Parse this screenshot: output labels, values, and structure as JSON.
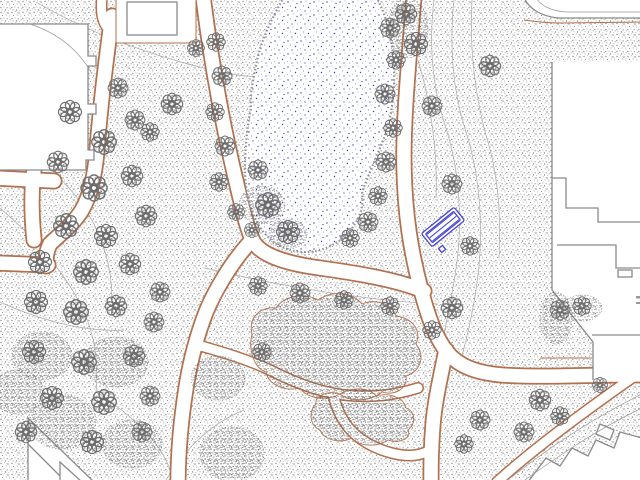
{
  "app": {
    "type": "cad-site-plan",
    "description": "Plan view of a park: pond, lawns with trees and shrubs, footpaths, surrounding buildings, contour lines, one highlighted bench"
  },
  "colors": {
    "background": "#ffffff",
    "grass_dot": "#909090",
    "shrub_dot": "#575757",
    "path_edge": "#b2714f",
    "path_core": "#ffffff",
    "building_outline": "#8a8a8a",
    "contour": "#a8a8a8",
    "pond_dot": "#3d3dcc",
    "pond_dot_light": "#8f8fdf",
    "pond_fringe": "#8f8f8f",
    "bench": "#4747d1",
    "tree_outline": "#6e6e6e"
  },
  "legend_features": [
    {
      "symbol": "pond",
      "desc": "water body, blue stipple on white"
    },
    {
      "symbol": "grass",
      "desc": "gray stipple ground texture"
    },
    {
      "symbol": "tree",
      "desc": "scalloped circular canopy symbol"
    },
    {
      "symbol": "shrub-mass",
      "desc": "dense dark stipple blob with brown edge"
    },
    {
      "symbol": "path",
      "desc": "white corridor with brown edges"
    },
    {
      "symbol": "building",
      "desc": "white footprint with gray outline"
    },
    {
      "symbol": "contour-line",
      "desc": "thin gray curve"
    },
    {
      "symbol": "bench",
      "desc": "blue highlighted street-furniture symbol"
    }
  ],
  "map": {
    "bench": {
      "x": 443,
      "y": 227,
      "rotation": -39,
      "length": 42,
      "width": 17,
      "slats": 3,
      "pad": {
        "dx": -17,
        "dy": 14,
        "size": 5
      }
    },
    "trees": [
      {
        "x": 70,
        "y": 112,
        "s": 1.5
      },
      {
        "x": 104,
        "y": 142,
        "s": 1.6
      },
      {
        "x": 135,
        "y": 120,
        "s": 1.3
      },
      {
        "x": 58,
        "y": 162,
        "s": 1.4
      },
      {
        "x": 94,
        "y": 188,
        "s": 1.7
      },
      {
        "x": 132,
        "y": 176,
        "s": 1.4
      },
      {
        "x": 66,
        "y": 226,
        "s": 1.6
      },
      {
        "x": 106,
        "y": 236,
        "s": 1.5
      },
      {
        "x": 146,
        "y": 216,
        "s": 1.4
      },
      {
        "x": 40,
        "y": 262,
        "s": 1.5
      },
      {
        "x": 86,
        "y": 272,
        "s": 1.6
      },
      {
        "x": 130,
        "y": 264,
        "s": 1.4
      },
      {
        "x": 160,
        "y": 292,
        "s": 1.3
      },
      {
        "x": 36,
        "y": 302,
        "s": 1.5
      },
      {
        "x": 76,
        "y": 312,
        "s": 1.6
      },
      {
        "x": 116,
        "y": 306,
        "s": 1.4
      },
      {
        "x": 154,
        "y": 322,
        "s": 1.3
      },
      {
        "x": 118,
        "y": 88,
        "s": 1.3
      },
      {
        "x": 172,
        "y": 104,
        "s": 1.4
      },
      {
        "x": 150,
        "y": 132,
        "s": 1.2
      },
      {
        "x": 196,
        "y": 48,
        "s": 1.1
      },
      {
        "x": 216,
        "y": 42,
        "s": 1.2
      },
      {
        "x": 222,
        "y": 76,
        "s": 1.3
      },
      {
        "x": 215,
        "y": 112,
        "s": 1.2
      },
      {
        "x": 225,
        "y": 146,
        "s": 1.3
      },
      {
        "x": 219,
        "y": 182,
        "s": 1.2
      },
      {
        "x": 236,
        "y": 212,
        "s": 1.1
      },
      {
        "x": 252,
        "y": 230,
        "s": 1.0
      },
      {
        "x": 268,
        "y": 205,
        "s": 1.6
      },
      {
        "x": 288,
        "y": 232,
        "s": 1.5
      },
      {
        "x": 258,
        "y": 170,
        "s": 1.3
      },
      {
        "x": 390,
        "y": 28,
        "s": 1.3
      },
      {
        "x": 396,
        "y": 60,
        "s": 1.2
      },
      {
        "x": 385,
        "y": 94,
        "s": 1.3
      },
      {
        "x": 393,
        "y": 128,
        "s": 1.2
      },
      {
        "x": 386,
        "y": 162,
        "s": 1.3
      },
      {
        "x": 378,
        "y": 196,
        "s": 1.2
      },
      {
        "x": 368,
        "y": 222,
        "s": 1.3
      },
      {
        "x": 350,
        "y": 238,
        "s": 1.2
      },
      {
        "x": 406,
        "y": 14,
        "s": 1.4
      },
      {
        "x": 416,
        "y": 44,
        "s": 1.5
      },
      {
        "x": 432,
        "y": 106,
        "s": 1.3
      },
      {
        "x": 490,
        "y": 66,
        "s": 1.4
      },
      {
        "x": 452,
        "y": 184,
        "s": 1.3
      },
      {
        "x": 470,
        "y": 246,
        "s": 1.2
      },
      {
        "x": 258,
        "y": 286,
        "s": 1.2
      },
      {
        "x": 300,
        "y": 293,
        "s": 1.3
      },
      {
        "x": 344,
        "y": 300,
        "s": 1.2
      },
      {
        "x": 390,
        "y": 306,
        "s": 1.2
      },
      {
        "x": 452,
        "y": 308,
        "s": 1.4
      },
      {
        "x": 432,
        "y": 330,
        "s": 1.2
      },
      {
        "x": 262,
        "y": 352,
        "s": 1.2
      },
      {
        "x": 34,
        "y": 352,
        "s": 1.5
      },
      {
        "x": 84,
        "y": 362,
        "s": 1.6
      },
      {
        "x": 134,
        "y": 356,
        "s": 1.4
      },
      {
        "x": 52,
        "y": 398,
        "s": 1.5
      },
      {
        "x": 104,
        "y": 402,
        "s": 1.6
      },
      {
        "x": 150,
        "y": 396,
        "s": 1.3
      },
      {
        "x": 26,
        "y": 432,
        "s": 1.4
      },
      {
        "x": 92,
        "y": 442,
        "s": 1.5
      },
      {
        "x": 142,
        "y": 432,
        "s": 1.3
      },
      {
        "x": 540,
        "y": 400,
        "s": 1.4
      },
      {
        "x": 524,
        "y": 432,
        "s": 1.3
      },
      {
        "x": 560,
        "y": 416,
        "s": 1.2
      },
      {
        "x": 480,
        "y": 420,
        "s": 1.3
      },
      {
        "x": 464,
        "y": 444,
        "s": 1.2
      },
      {
        "x": 600,
        "y": 385,
        "s": 1.0
      },
      {
        "x": 560,
        "y": 310,
        "s": 1.3
      },
      {
        "x": 582,
        "y": 306,
        "s": 1.2
      }
    ],
    "canopies": [
      {
        "x": 42,
        "y": 356,
        "rx": 30,
        "ry": 24
      },
      {
        "x": 116,
        "y": 362,
        "rx": 32,
        "ry": 25
      },
      {
        "x": 62,
        "y": 422,
        "rx": 34,
        "ry": 27
      },
      {
        "x": 132,
        "y": 444,
        "rx": 30,
        "ry": 24
      },
      {
        "x": 18,
        "y": 392,
        "rx": 26,
        "ry": 22
      },
      {
        "x": 218,
        "y": 378,
        "rx": 27,
        "ry": 22
      },
      {
        "x": 232,
        "y": 454,
        "rx": 32,
        "ry": 27
      },
      {
        "x": 408,
        "y": 28,
        "rx": 20,
        "ry": 30
      },
      {
        "x": 556,
        "y": 318,
        "rx": 16,
        "ry": 26
      },
      {
        "x": 582,
        "y": 308,
        "rx": 20,
        "ry": 13
      },
      {
        "x": 262,
        "y": 205,
        "rx": 23,
        "ry": 19
      },
      {
        "x": 288,
        "y": 234,
        "rx": 19,
        "ry": 15
      }
    ]
  }
}
